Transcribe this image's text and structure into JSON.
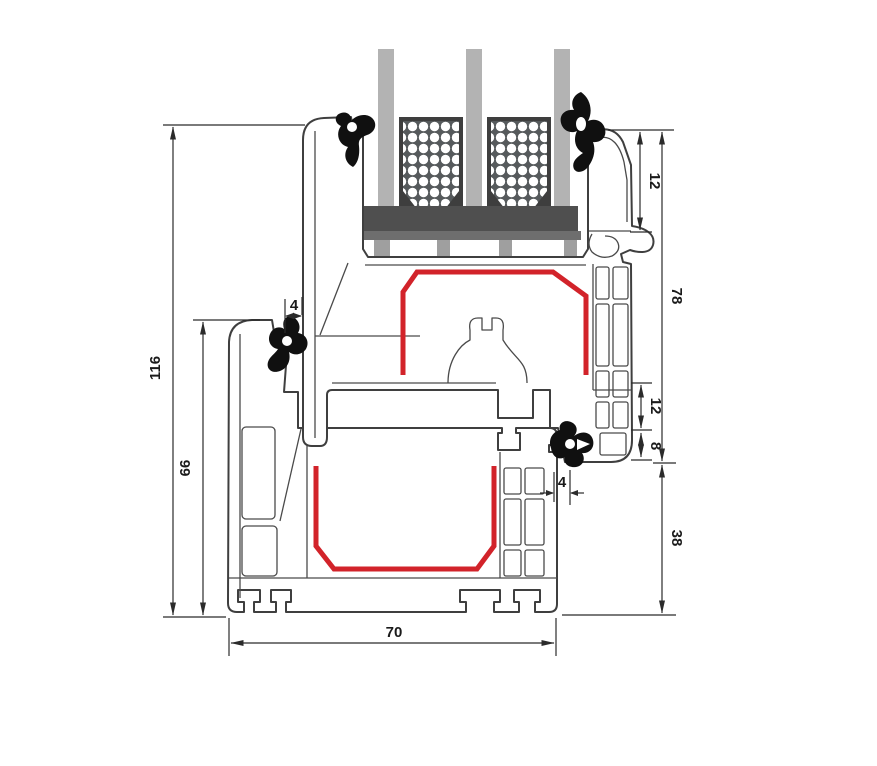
{
  "drawing": {
    "type": "window-profile-cross-section",
    "colors": {
      "outline": "#3f3f3f",
      "steel_red": "#d2232a",
      "glass_gray": "#b3b3b3",
      "spacer_frame": "#3e3e3e",
      "spacer_panel": "#565a5c",
      "block_dark": "#4f4f4f",
      "plate_gray": "#6e6e6e",
      "packer_gray": "#9f9f9f",
      "gasket_black": "#101010",
      "dimension_line": "#2b2b2b",
      "background": "#ffffff"
    },
    "dimensions": [
      {
        "id": "dim-116",
        "value": "116",
        "orientation": "vertical",
        "side": "left"
      },
      {
        "id": "dim-66",
        "value": "66",
        "orientation": "vertical",
        "side": "left"
      },
      {
        "id": "dim-4-top",
        "value": "4",
        "orientation": "horizontal",
        "side": "left"
      },
      {
        "id": "dim-12-top",
        "value": "12",
        "orientation": "vertical",
        "side": "right"
      },
      {
        "id": "dim-78",
        "value": "78",
        "orientation": "vertical",
        "side": "right"
      },
      {
        "id": "dim-12-mid",
        "value": "12",
        "orientation": "vertical",
        "side": "right"
      },
      {
        "id": "dim-8",
        "value": "8",
        "orientation": "vertical",
        "side": "right"
      },
      {
        "id": "dim-4-bottom",
        "value": "4",
        "orientation": "horizontal",
        "side": "right"
      },
      {
        "id": "dim-38",
        "value": "38",
        "orientation": "vertical",
        "side": "right"
      },
      {
        "id": "dim-70",
        "value": "70",
        "orientation": "horizontal",
        "side": "bottom"
      }
    ],
    "components": {
      "frame": "outer-frame-profile",
      "sash": "sash-profile",
      "glazing": "triple-glazing-unit",
      "spacers": "insulating-glass-spacer-bars",
      "block": "glazing-setting-block",
      "steel": "steel-reinforcement",
      "gaskets": "rubber-sealing-gaskets"
    }
  }
}
